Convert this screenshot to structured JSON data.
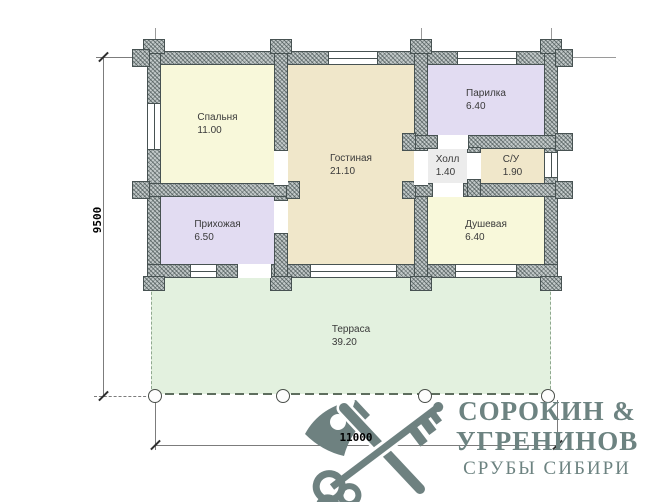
{
  "plan": {
    "rooms": [
      {
        "name": "Спальня",
        "area": "11.00"
      },
      {
        "name": "Прихожая",
        "area": "6.50"
      },
      {
        "name": "Гостиная",
        "area": "21.10"
      },
      {
        "name": "Парилка",
        "area": "6.40"
      },
      {
        "name": "Холл",
        "area": "1.40"
      },
      {
        "name": "С/У",
        "area": "1.90"
      },
      {
        "name": "Душевая",
        "area": "6.40"
      },
      {
        "name": "Терраса",
        "area": "39.20"
      }
    ],
    "dimensions": {
      "height_mm": "9500",
      "width_mm": "11000"
    }
  },
  "logo": {
    "line1": "СОРОКИН &",
    "line2": "УГРЕНИНОВ",
    "line3": "СРУБЫ СИБИРИ",
    "icon": "axe-and-key-icon",
    "color": "#6d8381"
  },
  "colors": {
    "wall": "#c3caca",
    "pale_yellow_fill": "#f8f8da",
    "wheat_fill": "#f0e7ca",
    "lavender_fill": "#e2dcf2",
    "hall_fill": "#ececec",
    "terrace_fill": "#e3f1df"
  }
}
